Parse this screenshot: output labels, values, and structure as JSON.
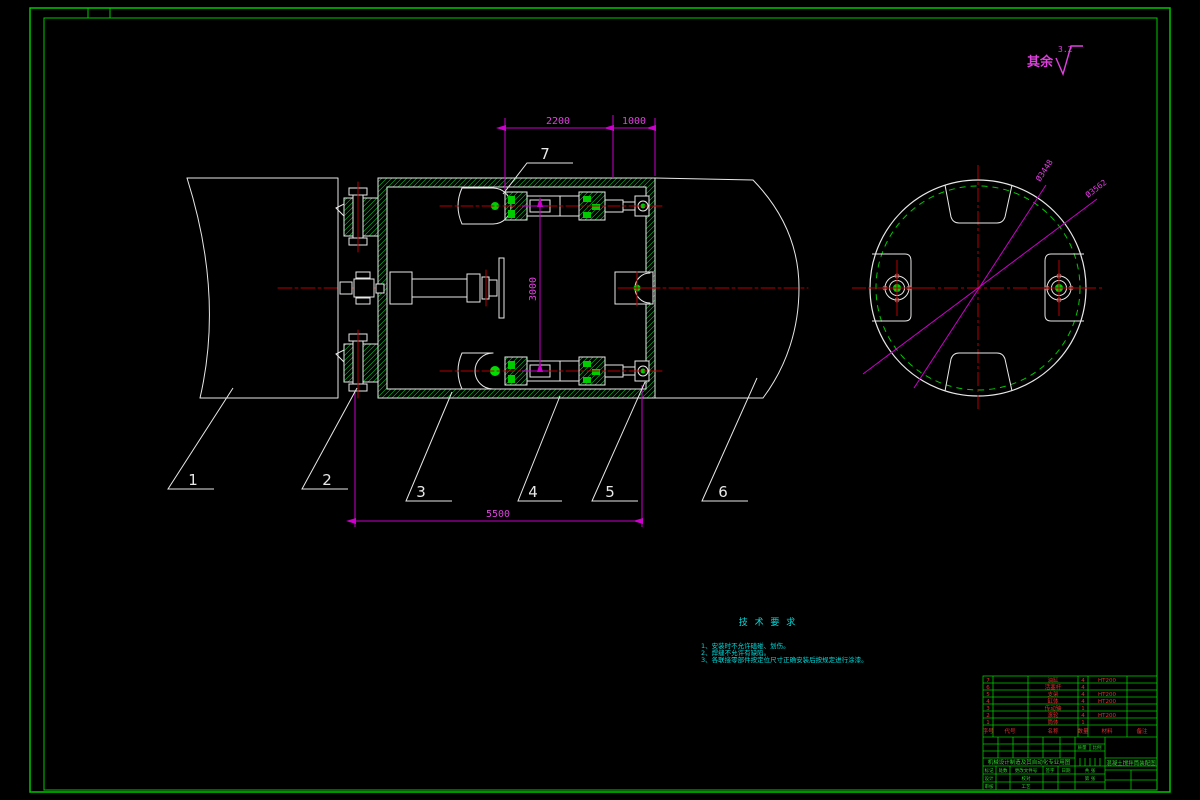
{
  "surface_note": {
    "prefix": "其余",
    "roughness": "3.2"
  },
  "dimensions": {
    "top_width": "2200",
    "top_right_width": "1000",
    "cylinder_spacing": "3000",
    "overall_length": "5500",
    "pitch_diameter": "Ø3448",
    "outer_diameter": "Ø3562"
  },
  "callouts": {
    "c1": "1",
    "c2": "2",
    "c3": "3",
    "c4": "4",
    "c5": "5",
    "c6": "6",
    "c7": "7"
  },
  "tech_requirements": {
    "title": "技 术 要 求",
    "item1": "1、安装时不允许磕碰、划伤。",
    "item2": "2、焊缝不允许有缺陷。",
    "item3": "3、各联接零部件按定位尺寸正确安装后按规定进行涂漆。"
  },
  "bom": {
    "headers": [
      "序号",
      "代号",
      "名称",
      "数量",
      "材料",
      "备注"
    ],
    "rows": [
      {
        "no": "7",
        "code": "",
        "name": "油缸",
        "qty": "4",
        "material": "HT200",
        "note": ""
      },
      {
        "no": "6",
        "code": "",
        "name": "活塞杆",
        "qty": "4",
        "material": "",
        "note": ""
      },
      {
        "no": "5",
        "code": "",
        "name": "支架",
        "qty": "4",
        "material": "HT200",
        "note": ""
      },
      {
        "no": "4",
        "code": "",
        "name": "缸体",
        "qty": "4",
        "material": "HT200",
        "note": ""
      },
      {
        "no": "3",
        "code": "",
        "name": "传动轴",
        "qty": "1",
        "material": "",
        "note": ""
      },
      {
        "no": "2",
        "code": "",
        "name": "滚轮",
        "qty": "4",
        "material": "HT200",
        "note": ""
      },
      {
        "no": "1",
        "code": "",
        "name": "筒体",
        "qty": "1",
        "material": "",
        "note": ""
      }
    ]
  },
  "titleblock": {
    "banner": "机械设计制造及其自动化专业用图",
    "drawing_title": "混凝土搅拌筒装配图",
    "mark": "标记",
    "count": "处数",
    "change": "更改文件号",
    "sign": "签字",
    "date": "日期",
    "design": "设计",
    "check": "校对",
    "audit": "审核",
    "process": "工艺",
    "mass": "质量",
    "scale": "比例",
    "sheets": "共 张",
    "sheetno": "第 张"
  }
}
